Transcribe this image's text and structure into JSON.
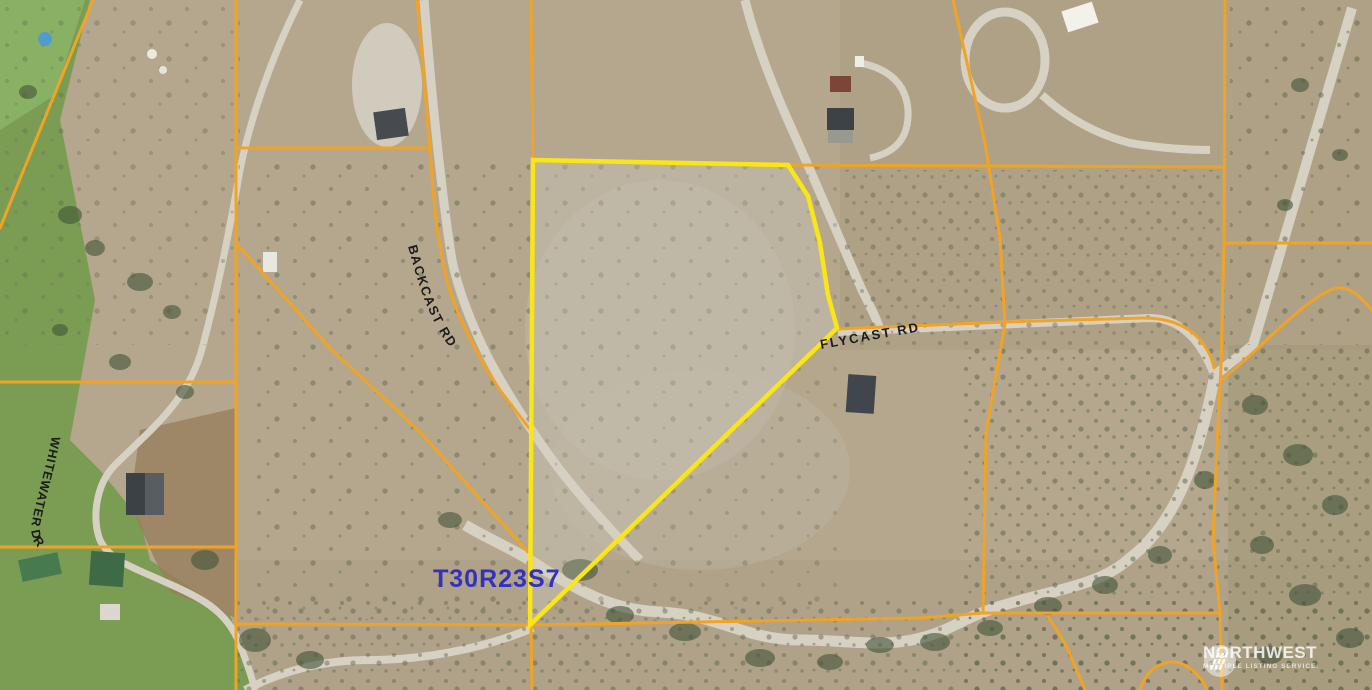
{
  "map": {
    "road_labels": {
      "backcast": "BACKCAST RD",
      "flycast": "FLYCAST RD",
      "whitewater": "WHITEWATER  DR"
    },
    "section_label": "T30R23S7",
    "watermark": {
      "brand": "NORTHWEST",
      "tagline": "MULTIPLE LISTING SERVICE."
    },
    "colors": {
      "parcel_line": "#F1A326",
      "highlight_outline": "#FAE616",
      "section_text": "#3232BE",
      "road_label_text": "#1B1B1B",
      "terrain_base": "#B4A78D",
      "field_green": "#7A9D53",
      "road_gray": "#D6D1C2"
    }
  }
}
